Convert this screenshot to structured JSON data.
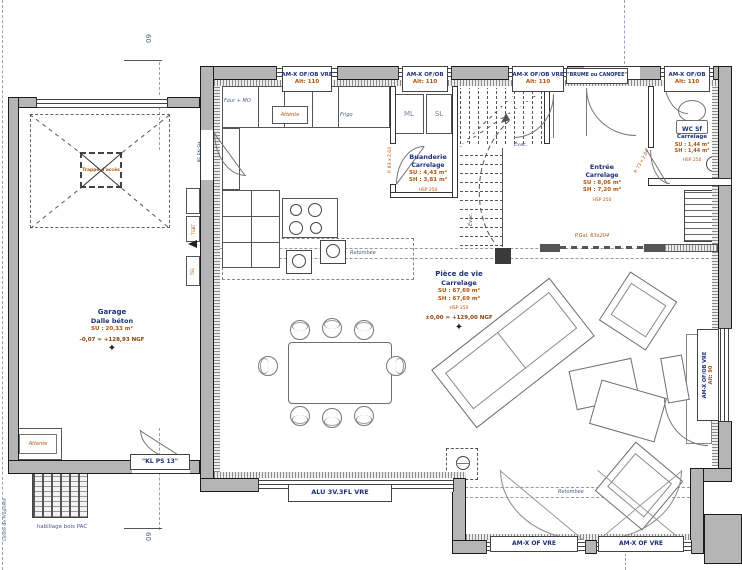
{
  "rooms": {
    "garage": {
      "name": "Garage",
      "floor": "Dalle béton",
      "su": "SU : 20,33 m²",
      "level": "-0,07 = +128,93 NGF"
    },
    "buanderie": {
      "name": "Buanderie",
      "floor": "Carrelage",
      "su": "SU : 4,43 m²",
      "sh": "SH : 3,81 m²",
      "hsp": "HSP 250"
    },
    "entree": {
      "name": "Entrée",
      "floor": "Carrelage",
      "su": "SU : 8,06 m²",
      "sh": "SH : 7,20 m²",
      "hsp": "HSP 250"
    },
    "wc": {
      "name": "WC Sf",
      "floor": "Carrelage",
      "su": "SU : 1,44 m²",
      "sh": "SH : 1,44 m²",
      "hsp": "HSP 250"
    },
    "piece_de_vie": {
      "name": "Pièce de vie",
      "floor": "Carrelage",
      "su": "SU : 67,69 m²",
      "sh": "SH : 67,69 m²",
      "hsp": "HSP 250",
      "level": "±0,00 = +129,00 NGF"
    }
  },
  "openings": {
    "top_windows": [
      {
        "name": "AM-X OF/OB VRE",
        "alt": "Alt: 110"
      },
      {
        "name": "AM-X OF/OB",
        "alt": "Alt: 110"
      },
      {
        "name": "AM-X OF/OB VRE",
        "alt": "Alt: 110"
      },
      {
        "name": "AM-X OF/OB",
        "alt": "Alt: 110"
      }
    ],
    "entry_door": "\"BRUME ou CANOPEE\"",
    "right_window": {
      "name": "AM-X OF/OB VRE",
      "alt": "Alt: 90"
    },
    "bay_windows": [
      {
        "name": "AM-X OF VRE"
      },
      {
        "name": "AM-X OF VRE"
      }
    ],
    "alu_bay": "ALU 3V.3FL VRE",
    "garage_ped_door": "\"KL PS 13\"",
    "pocket_door": "P.Gal. 63x204",
    "wc_door": "P. 73 x 2,04",
    "buanderie_door": "P. 83 x 2,04",
    "service_door": "PE EN.SH"
  },
  "kitchen": {
    "oven": "Four + MO",
    "pending": "Attente",
    "fridge": "Frigo",
    "washer": "ML",
    "dryer": "SL"
  },
  "garage_items": {
    "pending": "Attente",
    "pac_caption": "habillage bois PAC",
    "hatch": "Trappe d'accès",
    "panel1": "TGBT",
    "panel2": "TEL"
  },
  "annotations": {
    "beam": "Retombée",
    "beam2": "Retombée",
    "evac": "Évac.",
    "evac2": "Évac.",
    "property_line": "Limite de Propriété",
    "marker_top": "60",
    "marker_bottom": "60",
    "level_marker": "✦"
  }
}
